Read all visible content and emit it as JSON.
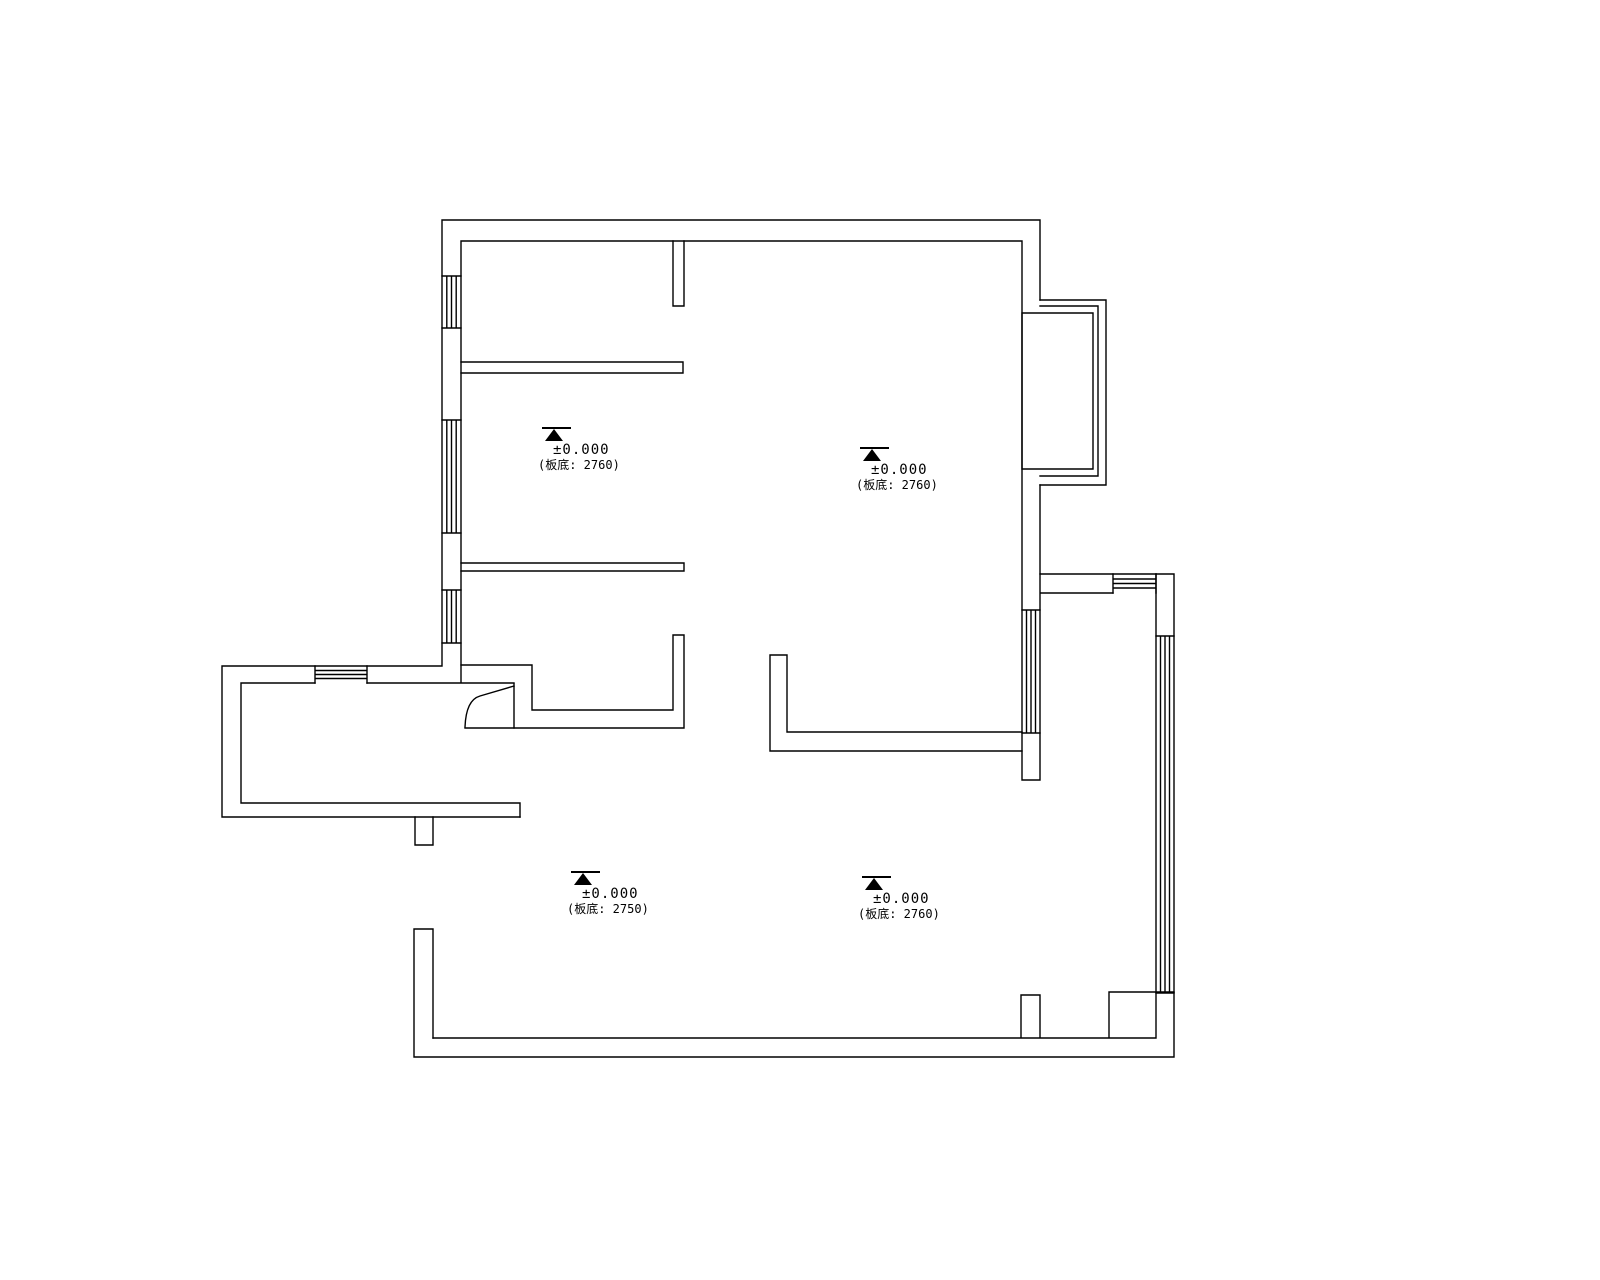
{
  "plan": {
    "background_color": "#ffffff",
    "line_color": "#000000",
    "annotations": [
      {
        "id": "upper-left-room",
        "elevation": "±0.000",
        "note": "(板底: 2760)"
      },
      {
        "id": "upper-right-room",
        "elevation": "±0.000",
        "note": "(板底: 2760)"
      },
      {
        "id": "lower-left-room",
        "elevation": "±0.000",
        "note": "(板底: 2750)"
      },
      {
        "id": "lower-right-room",
        "elevation": "±0.000",
        "note": "(板底: 2760)"
      }
    ]
  }
}
